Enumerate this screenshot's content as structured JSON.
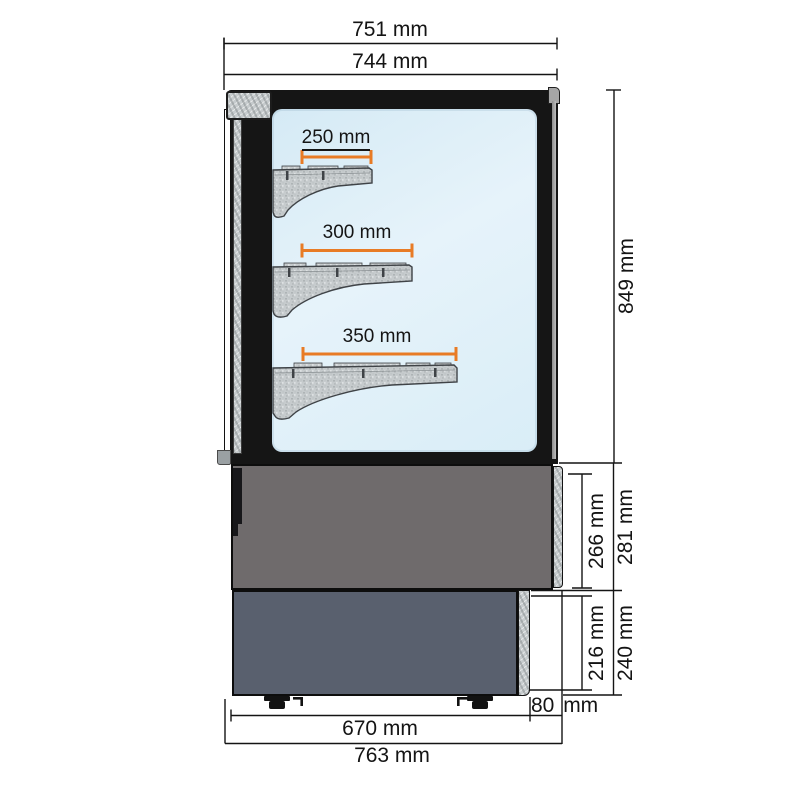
{
  "diagram": {
    "kind": "technical-dimension-drawing",
    "subject": "refrigerated pastry display case - side section with shelf brackets",
    "units": "mm",
    "dimensions": {
      "top": [
        {
          "id": "overall-width",
          "label": "751 mm",
          "value": 751
        },
        {
          "id": "body-width",
          "label": "744 mm",
          "value": 744
        }
      ],
      "shelves": [
        {
          "id": "shelf-top-depth",
          "label": "250 mm",
          "value": 250,
          "underlined": true
        },
        {
          "id": "shelf-middle-depth",
          "label": "300 mm",
          "value": 300
        },
        {
          "id": "shelf-bottom-depth",
          "label": "350 mm",
          "value": 350
        }
      ],
      "right": [
        {
          "id": "upper-body-height",
          "label": "849 mm",
          "value": 849
        },
        {
          "id": "mid-section-inner-height",
          "label": "266 mm",
          "value": 266
        },
        {
          "id": "mid-section-outer-height",
          "label": "281 mm",
          "value": 281
        },
        {
          "id": "base-inner-height",
          "label": "216 mm",
          "value": 216
        },
        {
          "id": "base-outer-height",
          "value": 240,
          "label": "240 mm"
        }
      ],
      "bottom": [
        {
          "id": "base-depth",
          "label": "670 mm",
          "value": 670
        },
        {
          "id": "overall-depth",
          "label": "763 mm",
          "value": 763
        },
        {
          "id": "rear-offset",
          "label": "80 mm",
          "value": 80
        }
      ]
    },
    "colors": {
      "dimension_accent": "#e87b25",
      "dimension_line": "#141414",
      "cabinet_frame": "#151515",
      "glass": "#ddeef7",
      "mid_panel": "#6f6b6c",
      "base_panel": "#59606e",
      "galvanized_metal": "#c6cbcd"
    }
  }
}
